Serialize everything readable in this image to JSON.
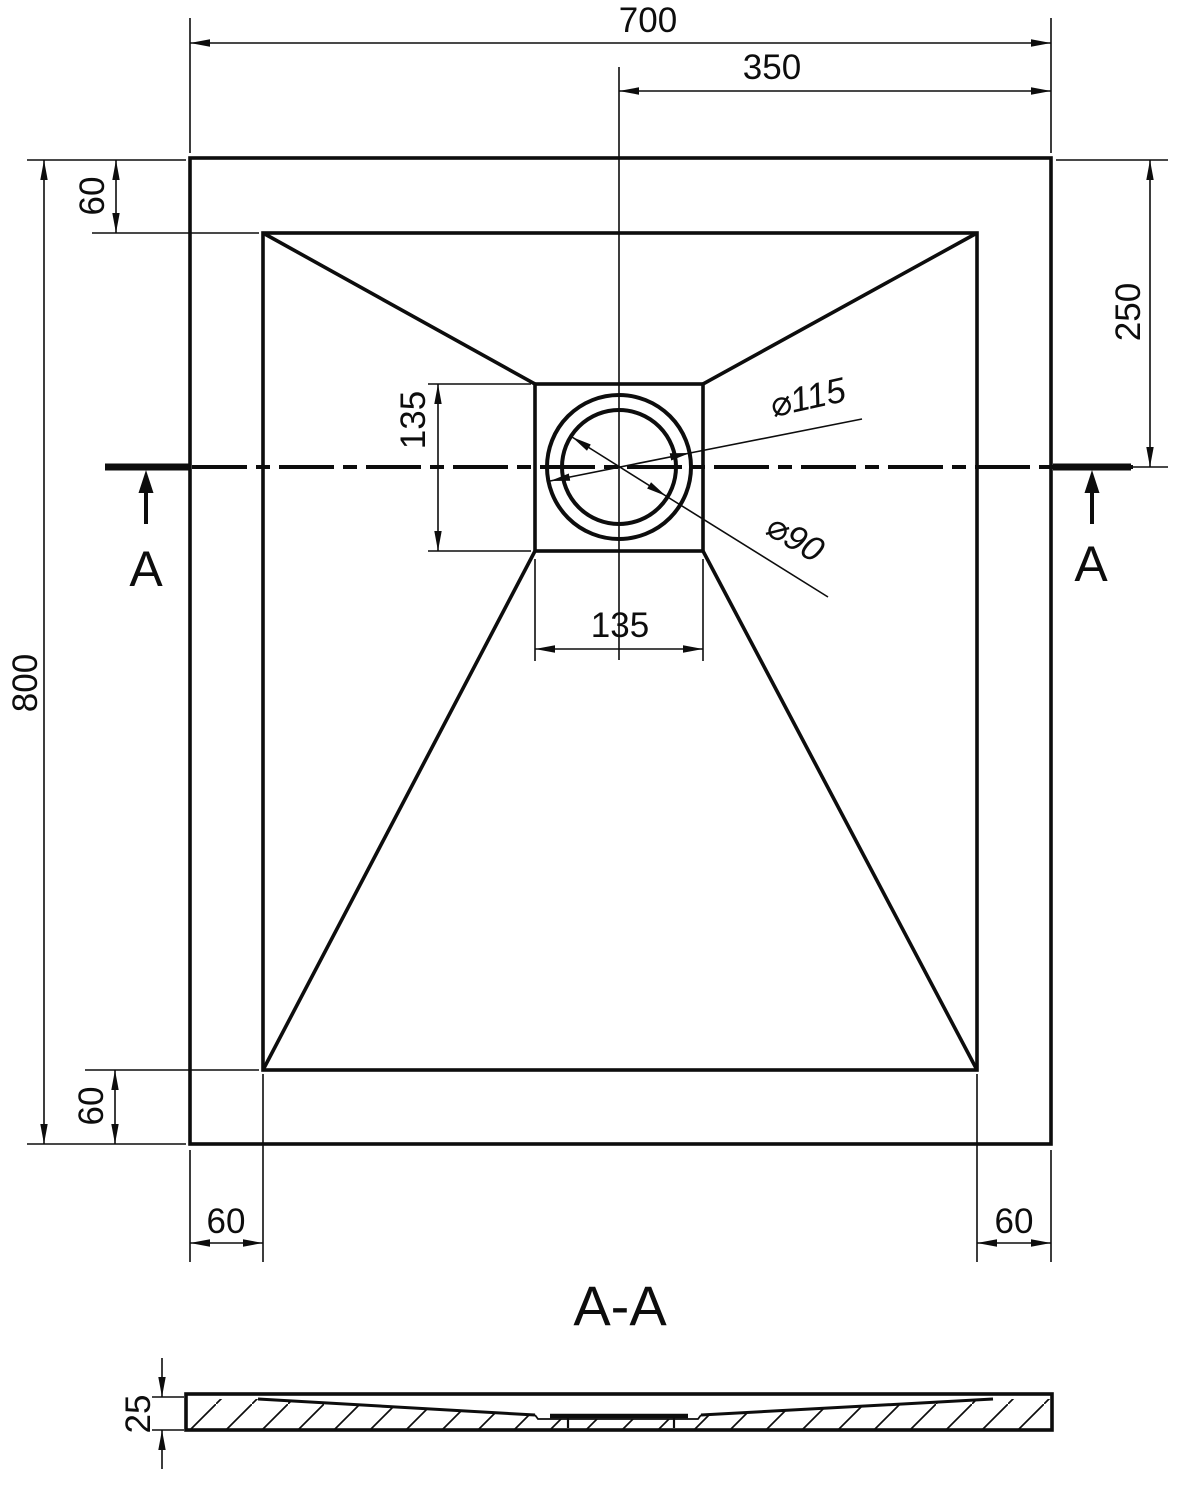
{
  "drawing": {
    "plan": {
      "dim_width_total": "700",
      "dim_width_center_to_right": "350",
      "dim_rim_top": "60",
      "dim_drain_center_from_top": "250",
      "dim_height_total": "800",
      "dim_rim_bottom": "60",
      "dim_drain_box_height": "135",
      "dim_drain_box_width": "135",
      "dim_drain_outer_diameter": "⌀115",
      "dim_drain_inner_diameter": "⌀90",
      "dim_rim_left": "60",
      "dim_rim_right": "60",
      "section_marker_left": "A",
      "section_marker_right": "A"
    },
    "section": {
      "title": "A-A",
      "dim_thickness": "25"
    },
    "colors": {
      "line": "#0d0d0d",
      "background": "#ffffff"
    }
  }
}
